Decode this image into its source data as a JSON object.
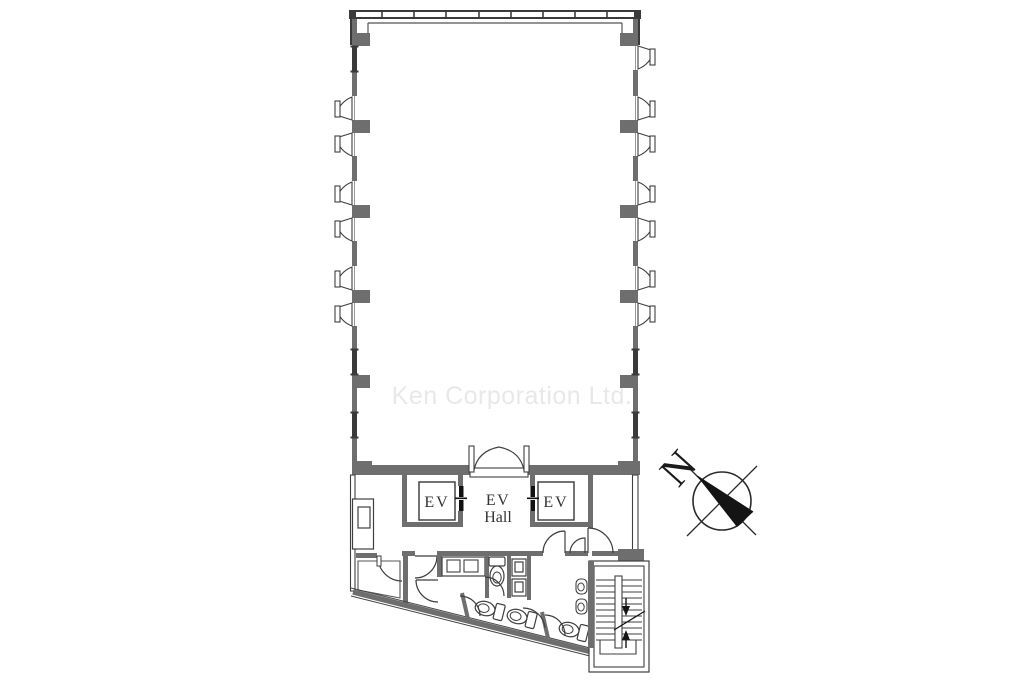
{
  "watermark": {
    "text": "Ken Corporation Ltd."
  },
  "plan": {
    "labels": {
      "ev": "EV",
      "ev_hall_line1": "EV",
      "ev_hall_line2": "Hall",
      "north": "N"
    },
    "colors": {
      "wall": "#6e6e6e",
      "wall_dark": "#3a3a3a",
      "line": "#3f3f3f",
      "watermark": "#e8e8e8",
      "compass_needle": "#141414"
    }
  }
}
